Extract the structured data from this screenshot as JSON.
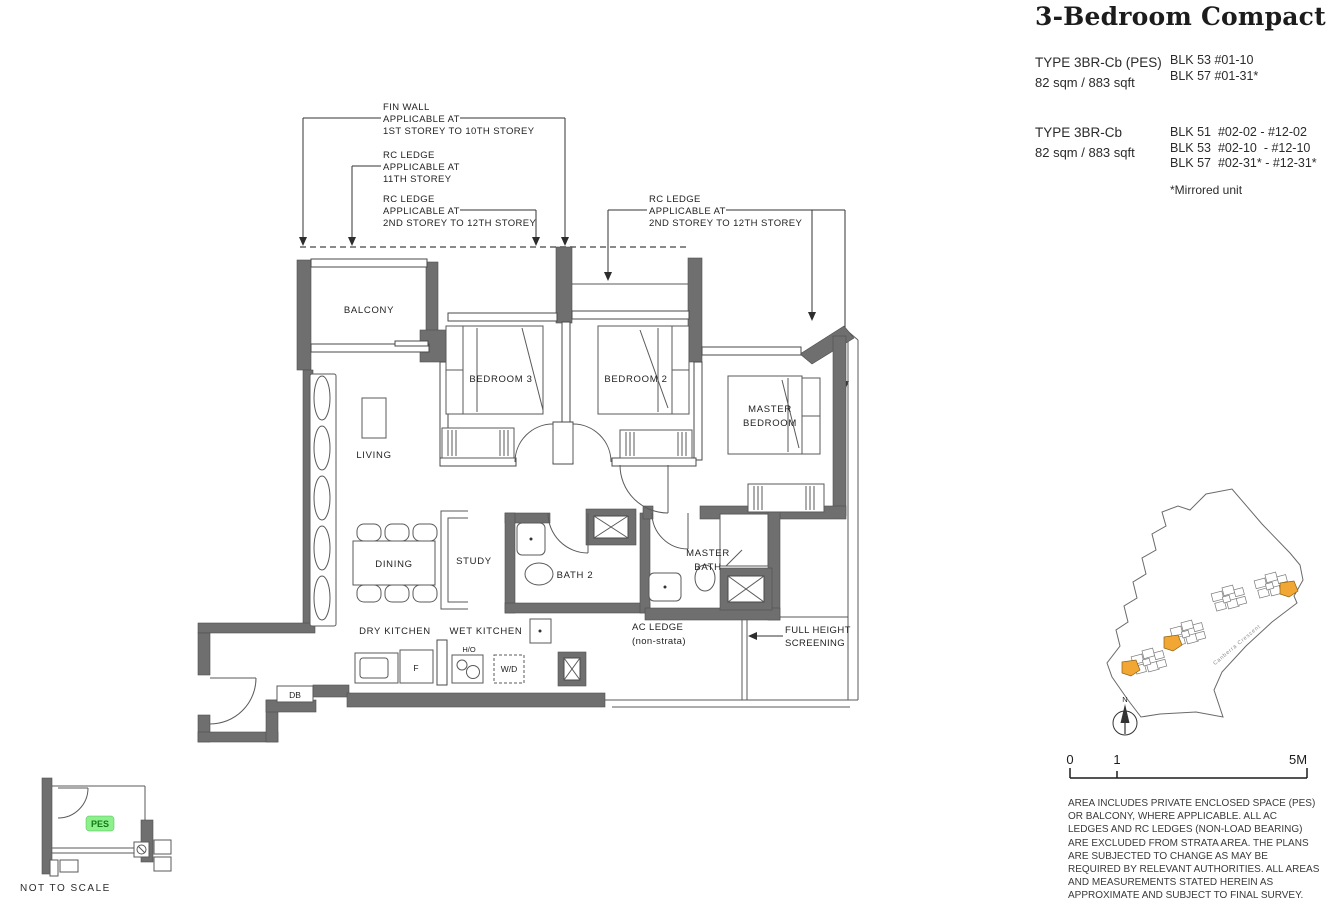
{
  "header": {
    "title": "3-Bedroom Compact"
  },
  "unit_types": [
    {
      "name": "TYPE 3BR-Cb (PES)",
      "area": "82 sqm / 883 sqft",
      "blocks": [
        "BLK 53 #01-10",
        "BLK 57 #01-31*"
      ]
    },
    {
      "name": "TYPE 3BR-Cb",
      "area": "82 sqm / 883 sqft",
      "blocks": [
        "BLK 51  #02-02 - #12-02",
        "BLK 53  #02-10  - #12-10",
        "BLK 57  #02-31* - #12-31*"
      ]
    }
  ],
  "mirrored_note": "*Mirrored unit",
  "floorplan": {
    "annotations": {
      "fin_wall": [
        "FIN WALL",
        "APPLICABLE AT",
        "1ST STOREY TO 10TH  STOREY"
      ],
      "rc_ledge_11": [
        "RC LEDGE",
        "APPLICABLE AT",
        "11TH STOREY"
      ],
      "rc_ledge_left": [
        "RC LEDGE",
        "APPLICABLE AT",
        "2ND STOREY TO 12TH  STOREY"
      ],
      "rc_ledge_right": [
        "RC LEDGE",
        "APPLICABLE AT",
        "2ND STOREY TO 12TH  STOREY"
      ],
      "ac_ledge": [
        "AC LEDGE",
        "(non-strata)"
      ],
      "screening": [
        "FULL HEIGHT",
        "SCREENING"
      ]
    },
    "rooms": {
      "balcony": "BALCONY",
      "living": "LIVING",
      "bedroom3": "BEDROOM 3",
      "bedroom2": "BEDROOM 2",
      "master_bedroom_1": "MASTER",
      "master_bedroom_2": "BEDROOM",
      "dining": "DINING",
      "study": "STUDY",
      "bath2": "BATH 2",
      "master_bath_1": "MASTER",
      "master_bath_2": "BATH",
      "dry_kitchen": "DRY KITCHEN",
      "wet_kitchen": "WET KITCHEN"
    },
    "fixtures": {
      "db": "DB",
      "fridge": "F",
      "hob": "H/O",
      "washer": "W/D"
    },
    "colors": {
      "wall": "#6f6f6f"
    }
  },
  "inset": {
    "pes": "PES",
    "note": "NOT TO SCALE",
    "pes_bg": "#8df08d",
    "pes_text": "#117a11"
  },
  "sitemap": {
    "road": "Canberra Crescent",
    "compass": "N",
    "highlight": "#f2a735"
  },
  "scalebar": {
    "start": "0",
    "mid": "1",
    "end": "5M"
  },
  "disclaimer": "AREA INCLUDES PRIVATE ENCLOSED SPACE (PES) OR BALCONY, WHERE APPLICABLE. ALL AC LEDGES AND RC LEDGES (NON-LOAD BEARING) ARE EXCLUDED FROM STRATA AREA. THE PLANS ARE SUBJECTED TO CHANGE AS MAY BE REQUIRED BY RELEVANT AUTHORITIES. ALL AREAS AND MEASUREMENTS STATED HEREIN AS APPROXIMATE AND SUBJECT TO FINAL SURVEY."
}
